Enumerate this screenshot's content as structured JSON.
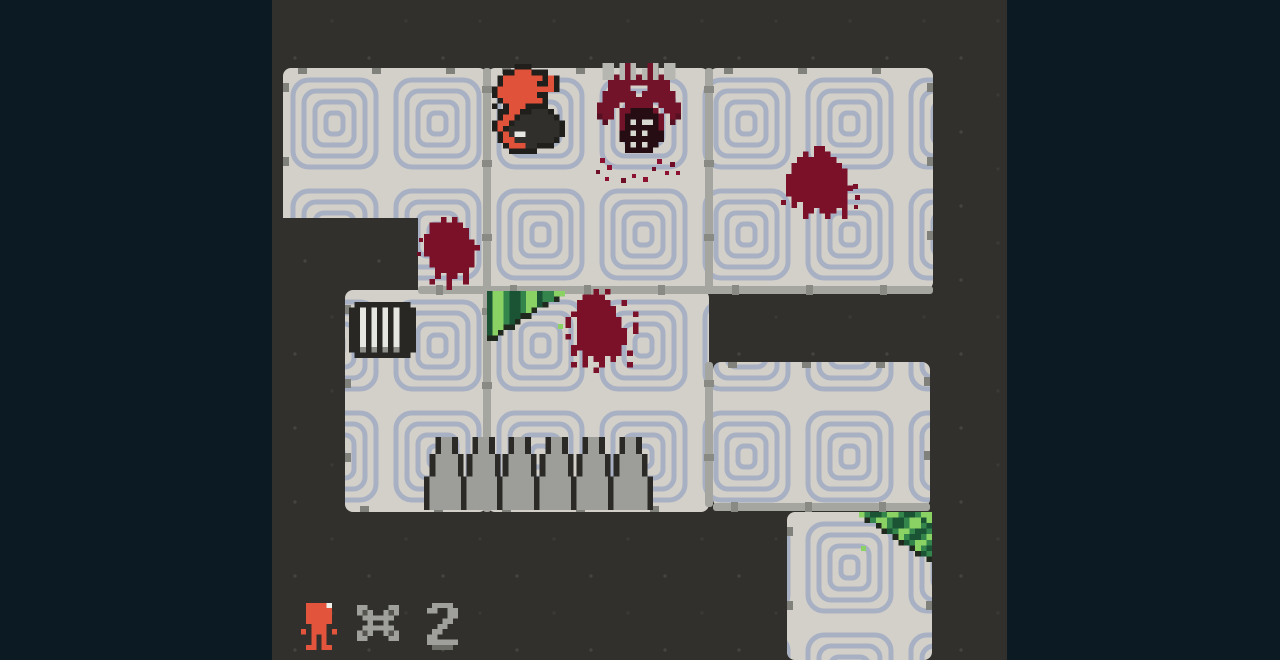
{
  "viewport": {
    "x": 272,
    "y": 0,
    "width": 735,
    "height": 660
  },
  "colors": {
    "letterbox": "#0b1a23",
    "wall": "#31302d",
    "wall_speck": "#45443f",
    "floor": "#d3d0ca",
    "maze_line": "#a8b0c3",
    "gutter": "#a6a6a0",
    "gutter_tick": "#8a8a84",
    "edge_tick": "#81817b",
    "blood": "#7a1129",
    "blood_bright": "#8c1130",
    "blood_dark": "#6f0e26",
    "player_orange": "#e0523a",
    "spike_gray": "#9d9d99",
    "grass_light": "#8ad264",
    "grass_mid": "#33854b",
    "grass_dark": "#1a5434",
    "hud_gray": "#9f9f9b"
  },
  "rooms": [
    {
      "name": "room-top-left",
      "x": 283,
      "y": 68,
      "w": 204,
      "h": 222,
      "ticks": {
        "top": true,
        "left": true,
        "right": false,
        "bottom": false
      }
    },
    {
      "name": "room-top-mid",
      "x": 487,
      "y": 68,
      "w": 222,
      "h": 222,
      "ticks": {
        "top": true,
        "left": false,
        "right": false,
        "bottom": false
      }
    },
    {
      "name": "room-top-right",
      "x": 709,
      "y": 68,
      "w": 224,
      "h": 222,
      "ticks": {
        "top": true,
        "left": false,
        "right": true,
        "bottom": false
      }
    },
    {
      "name": "room-mid-left",
      "x": 345,
      "y": 290,
      "w": 142,
      "h": 222,
      "ticks": {
        "top": false,
        "left": true,
        "right": false,
        "bottom": true
      }
    },
    {
      "name": "room-mid",
      "x": 487,
      "y": 290,
      "w": 222,
      "h": 222,
      "ticks": {
        "top": false,
        "left": false,
        "right": false,
        "bottom": true
      }
    },
    {
      "name": "room-right",
      "x": 713,
      "y": 362,
      "w": 217,
      "h": 145,
      "ticks": {
        "top": true,
        "left": false,
        "right": true,
        "bottom": false
      }
    },
    {
      "name": "room-bottom-right",
      "x": 787,
      "y": 512,
      "w": 145,
      "h": 148,
      "ticks": {
        "top": false,
        "left": true,
        "right": true,
        "bottom": false
      }
    }
  ],
  "gutters": [
    {
      "x": 483,
      "y": 68,
      "w": 8,
      "h": 444
    },
    {
      "x": 705,
      "y": 68,
      "w": 8,
      "h": 222
    },
    {
      "x": 705,
      "y": 362,
      "w": 8,
      "h": 145
    },
    {
      "x": 418,
      "y": 286,
      "w": 515,
      "h": 8
    },
    {
      "x": 713,
      "y": 503,
      "w": 217,
      "h": 8
    }
  ],
  "wall_overlays": [
    {
      "x": 272,
      "y": 218,
      "w": 146,
      "h": 72
    }
  ],
  "pattern": {
    "cell_w": 103,
    "cell_h": 111,
    "origin_x": 283,
    "origin_y": 68,
    "stroke_w": 5,
    "rings": [
      [
        10,
        12,
        83,
        87,
        16
      ],
      [
        21,
        23,
        61,
        65,
        12
      ],
      [
        32,
        34,
        39,
        43,
        9
      ],
      [
        43,
        45,
        17,
        21,
        6
      ]
    ]
  },
  "sprites": {
    "player": {
      "palette": {
        "k": "#201f1c",
        "o": "#e0523a",
        "d": "#302f2c",
        "w": "#e6e6e2"
      },
      "rows": [
        "....kkk......",
        "..kkoookkk...",
        ".koooooookok.",
        ".kooooookkok.",
        "kooooooooook.",
        "koooooookk..",
        ".koooooook...",
        "k.koookkkk..",
        ".kkookkdddk..",
        ".kookddddddk.",
        "kookddddddddk",
        "kokdddddddddk",
        ".kodwwddddddk",
        ".koodddddddk.",
        "..koooddkkk..",
        "...kkkkk....."
      ]
    },
    "jaw": {
      "palette": {
        "G": "#b7b7b1",
        "m": "#731329",
        "M": "#570f22",
        "f": "#260d14",
        "t": "#d8d8d2"
      },
      "rows": [
        ".GG.GmG..mG.GG.",
        ".GG.GmG.GmG.GG.",
        ".GGmGmGmGmGmGG.",
        "..mmmmmmmmmmm..",
        "..mmmm...mmmm..",
        ".mmmmmm.mmmmmm.",
        ".mmmmmmmmmmmmm.",
        "mmmm.mmmmm.mmmm",
        "mmm.mmffffm.mmm",
        "Mmm.mffffffm.mM",
        ".M..mftfttfm.M.",
        "....mffffffm...",
        "....fftftfff...",
        "....ffffffff...",
        ".....ftftff....",
        ".....fffff....."
      ]
    },
    "blood_a3": {
      "palette": {
        "b": "#7a1129"
      },
      "rows": [
        ".....bb.....",
        "...b.bbb....",
        "..bbbbbbb...",
        ".bbbbbbbbb..",
        ".bbbbbbbbbb.",
        "bbbbbbbbbbb.",
        "bbbbbbbbbbb.",
        "bbbbbbbbbbbb",
        "bbbbbbbbbbb.",
        ".bbbbbbbbbb.",
        ".b.bbbbbbbb.",
        "...bb.bbb.b.",
        "...b...b..b."
      ]
    },
    "blood_door": {
      "palette": {
        "b": "#7a1129"
      },
      "rows": [
        "...b.b....",
        ".bbbbbb...",
        ".bbbbbbb..",
        "bbbbbbbb..",
        "bbbbbbbbb.",
        "bbbbbbbbbb",
        "bbbbbbbbb.",
        ".bbbbbbbb.",
        ".bbbbbbbb.",
        "..bbbbbb..",
        "..b.bb.b..",
        ".b..b..b..",
        "....b....."
      ]
    },
    "blood_b": {
      "palette": {
        "b": "#7a1129"
      },
      "rows": [
        "......b.b......",
        "....bbbb.......",
        "...bbbbbb..b...",
        "...bbbbbbb.....",
        "..bbbbbbbb...b.",
        ".b.bbbbbbbb....",
        ".b.bbbbbbbb..b.",
        "...bbbbbbbbb.b.",
        ".b.bbbbbbbbb...",
        "...bbbbbbbbb...",
        "..bbbbbbbbb....",
        "..b.bbbbbbb.b..",
        "....b.bb.b.....",
        "..b.b..b....b..",
        "......b........"
      ]
    },
    "grate": {
      "palette": {
        "k": "#282724",
        "W": "#e7e7e2",
        "s": "#8f8f8a"
      },
      "rows": [
        ".kkkkkkkkkk.",
        "kkWkWkWkWkkk",
        "kkWkWkWkWkkk",
        "kkWkWkWkWkkk",
        "kkWkWkWkWkkk",
        "kkWkWkWkWkkk",
        "kkWkWkWkWkkk",
        "kkWkWkWkWkkk",
        "kkskskskskkk",
        ".kkkkkkkkkk."
      ]
    },
    "grass_b": {
      "palette": {
        "L": "#8ad264",
        "g": "#33854b",
        "D": "#1a5434",
        "k": "#20291d"
      },
      "rows": [
        "DLLgDDgLLDggLL",
        "DLLgDDgLLDggk.",
        "DLLgDDgLLDk...",
        "DLLgDDgLk.....",
        "DLLgDDkk......",
        "DLLgDk........",
        "DLLkk.........",
        "DLk...........",
        "kk............"
      ]
    },
    "grass_d": {
      "palette": {
        "L": "#8ad264",
        "g": "#33854b",
        "D": "#1a5434",
        "k": "#20291d"
      },
      "rows": [
        "LgDDgLLgDDgLL",
        ".kgLLgDDgLLDL",
        "...kLgDDgLLgD",
        "....kDgLLgDDg",
        "......kLgDDgL",
        ".......kDgLLg",
        ".........kLgD",
        "..........kDg",
        "............k"
      ]
    },
    "spike": {
      "palette": {
        "k": "#2b2a27",
        "s": "#9d9d99"
      },
      "rows": [
        "..kssk..",
        "..kssk..",
        "..kssk..",
        ".kssssk.",
        ".kssssk.",
        ".kssssk.",
        ".kssssk.",
        "kssssssk",
        "kssssssk",
        "kssssssk",
        "kssssssk",
        "kssssssk",
        "kssssssk"
      ]
    },
    "hud_player": {
      "palette": {
        "o": "#e2543c",
        "w": "#efefeb"
      },
      "rows": [
        ".oooow.",
        ".ooooo.",
        ".ooooo.",
        ".ooooo.",
        "..ooo..",
        "o.ooo.o",
        "..o.o..",
        "..o.o..",
        ".oo.oo."
      ]
    },
    "hud_x": {
      "palette": {
        "g": "#9f9f9b",
        "d": "#55544f"
      },
      "rows": [
        "gg....gg",
        "gdg..gdg",
        ".gggggg.",
        "..g..g..",
        ".gggggg.",
        "gdg..gdg",
        "gg....gg"
      ]
    },
    "hud_two": {
      "palette": {
        "g": "#9f9f9b",
        "d": "#6e6e69"
      },
      "rows": [
        ".gggg.",
        "gg..gg",
        "....gg",
        "...gg.",
        "..gg..",
        ".gg...",
        "gg....",
        "gggggg",
        ".dddd."
      ]
    }
  },
  "entities": [
    {
      "name": "player-sprite",
      "sprite": "player",
      "x": 492,
      "y": 64,
      "u": 5.6
    },
    {
      "name": "ceiling-jaw-enemy",
      "sprite": "jaw",
      "x": 597,
      "y": 63,
      "u": 5.6
    },
    {
      "name": "blood-splat-top-right",
      "sprite": "blood_a3",
      "x": 786,
      "y": 146,
      "u": 5.6
    },
    {
      "name": "blood-splat-doorway",
      "sprite": "blood_door",
      "x": 424,
      "y": 217,
      "u": 5.6
    },
    {
      "name": "blood-splat-mid-room",
      "sprite": "blood_b",
      "x": 560,
      "y": 289,
      "u": 5.6
    },
    {
      "name": "wall-grate",
      "sprite": "grate",
      "x": 349,
      "y": 302,
      "u": 5.6
    },
    {
      "name": "grass-patch-mid",
      "sprite": "grass_b",
      "x": 487,
      "y": 291,
      "u": 5.6
    },
    {
      "name": "grass-patch-bottom-right",
      "sprite": "grass_d",
      "x": 859,
      "y": 512,
      "u": 5.6
    },
    {
      "name": "spike-trap",
      "sprite": "spike",
      "x": 424,
      "y": 437,
      "u": 5.6
    },
    {
      "name": "spike-trap",
      "sprite": "spike",
      "x": 461,
      "y": 437,
      "u": 5.6
    },
    {
      "name": "spike-trap",
      "sprite": "spike",
      "x": 497,
      "y": 437,
      "u": 5.6
    },
    {
      "name": "spike-trap",
      "sprite": "spike",
      "x": 534,
      "y": 437,
      "u": 5.6
    },
    {
      "name": "spike-trap",
      "sprite": "spike",
      "x": 571,
      "y": 437,
      "u": 5.6
    },
    {
      "name": "spike-trap",
      "sprite": "spike",
      "x": 608,
      "y": 437,
      "u": 5.6
    },
    {
      "name": "hud-player-icon",
      "sprite": "hud_player",
      "x": 301,
      "y": 603,
      "u": 5.2
    },
    {
      "name": "hud-multiply-icon",
      "sprite": "hud_x",
      "x": 357,
      "y": 605,
      "u": 5.2
    },
    {
      "name": "hud-lives-count",
      "sprite": "hud_two",
      "x": 427,
      "y": 603,
      "u": 5.2
    }
  ],
  "droplets": [
    {
      "x": 600,
      "y": 158,
      "s": 5,
      "c": "blood_bright"
    },
    {
      "x": 596,
      "y": 170,
      "s": 4,
      "c": "blood_dark"
    },
    {
      "x": 607,
      "y": 165,
      "s": 5,
      "c": "blood_bright"
    },
    {
      "x": 605,
      "y": 177,
      "s": 4,
      "c": "blood_bright"
    },
    {
      "x": 621,
      "y": 178,
      "s": 5,
      "c": "blood_dark"
    },
    {
      "x": 632,
      "y": 174,
      "s": 4,
      "c": "blood_bright"
    },
    {
      "x": 643,
      "y": 177,
      "s": 5,
      "c": "blood_bright"
    },
    {
      "x": 652,
      "y": 167,
      "s": 4,
      "c": "blood_dark"
    },
    {
      "x": 657,
      "y": 159,
      "s": 5,
      "c": "blood_bright"
    },
    {
      "x": 665,
      "y": 171,
      "s": 4,
      "c": "blood_bright"
    },
    {
      "x": 670,
      "y": 162,
      "s": 5,
      "c": "blood_dark"
    },
    {
      "x": 676,
      "y": 171,
      "s": 4,
      "c": "blood_bright"
    },
    {
      "x": 853,
      "y": 184,
      "s": 5,
      "c": "blood"
    },
    {
      "x": 855,
      "y": 195,
      "s": 5,
      "c": "blood"
    },
    {
      "x": 854,
      "y": 205,
      "s": 4,
      "c": "blood"
    },
    {
      "x": 781,
      "y": 200,
      "s": 5,
      "c": "blood"
    },
    {
      "x": 419,
      "y": 238,
      "s": 4,
      "c": "blood"
    },
    {
      "x": 417,
      "y": 252,
      "s": 4,
      "c": "blood_dark"
    },
    {
      "x": 558,
      "y": 324,
      "s": 5,
      "c": "grass_light"
    },
    {
      "x": 861,
      "y": 546,
      "s": 5,
      "c": "grass_light"
    }
  ],
  "hud": {
    "lives_count": "2"
  }
}
